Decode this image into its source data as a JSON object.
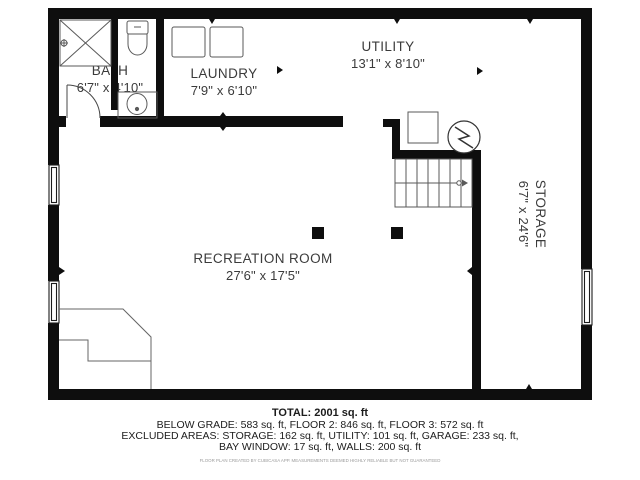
{
  "floor_plan": {
    "rooms": [
      {
        "id": "bath",
        "name": "BATH",
        "dims": "6'7\" x 4'10\""
      },
      {
        "id": "laundry",
        "name": "LAUNDRY",
        "dims": "7'9\" x 6'10\""
      },
      {
        "id": "utility",
        "name": "UTILITY",
        "dims": "13'1\" x 8'10\""
      },
      {
        "id": "recreation",
        "name": "RECREATION ROOM",
        "dims": "27'6\" x 17'5\""
      },
      {
        "id": "storage",
        "name": "STORAGE",
        "dims": "6'7\" x 24'6\""
      }
    ],
    "fixtures": [
      "shower",
      "toilet",
      "sink",
      "door",
      "washer",
      "dryer",
      "furnace",
      "electrical-panel",
      "staircase",
      "window",
      "support-post"
    ]
  },
  "summary": {
    "total": "TOTAL: 2001 sq. ft",
    "lines": [
      "BELOW GRADE: 583 sq. ft, FLOOR 2: 846 sq. ft, FLOOR 3: 572 sq. ft",
      "EXCLUDED AREAS: STORAGE: 162 sq. ft, UTILITY: 101 sq. ft, GARAGE: 233 sq. ft,",
      "BAY WINDOW: 17 sq. ft, WALLS: 200 sq. ft"
    ],
    "disclaimer": "FLOOR PLAN CREATED BY CUBICASA APP. MEASUREMENTS DEEMED HIGHLY RELIABLE BUT NOT GUARANTEED"
  },
  "colors": {
    "wall": "#0e0e0e",
    "fixture_line": "#5a5a5a",
    "text": "#3b3b3b",
    "background": "#ffffff"
  }
}
